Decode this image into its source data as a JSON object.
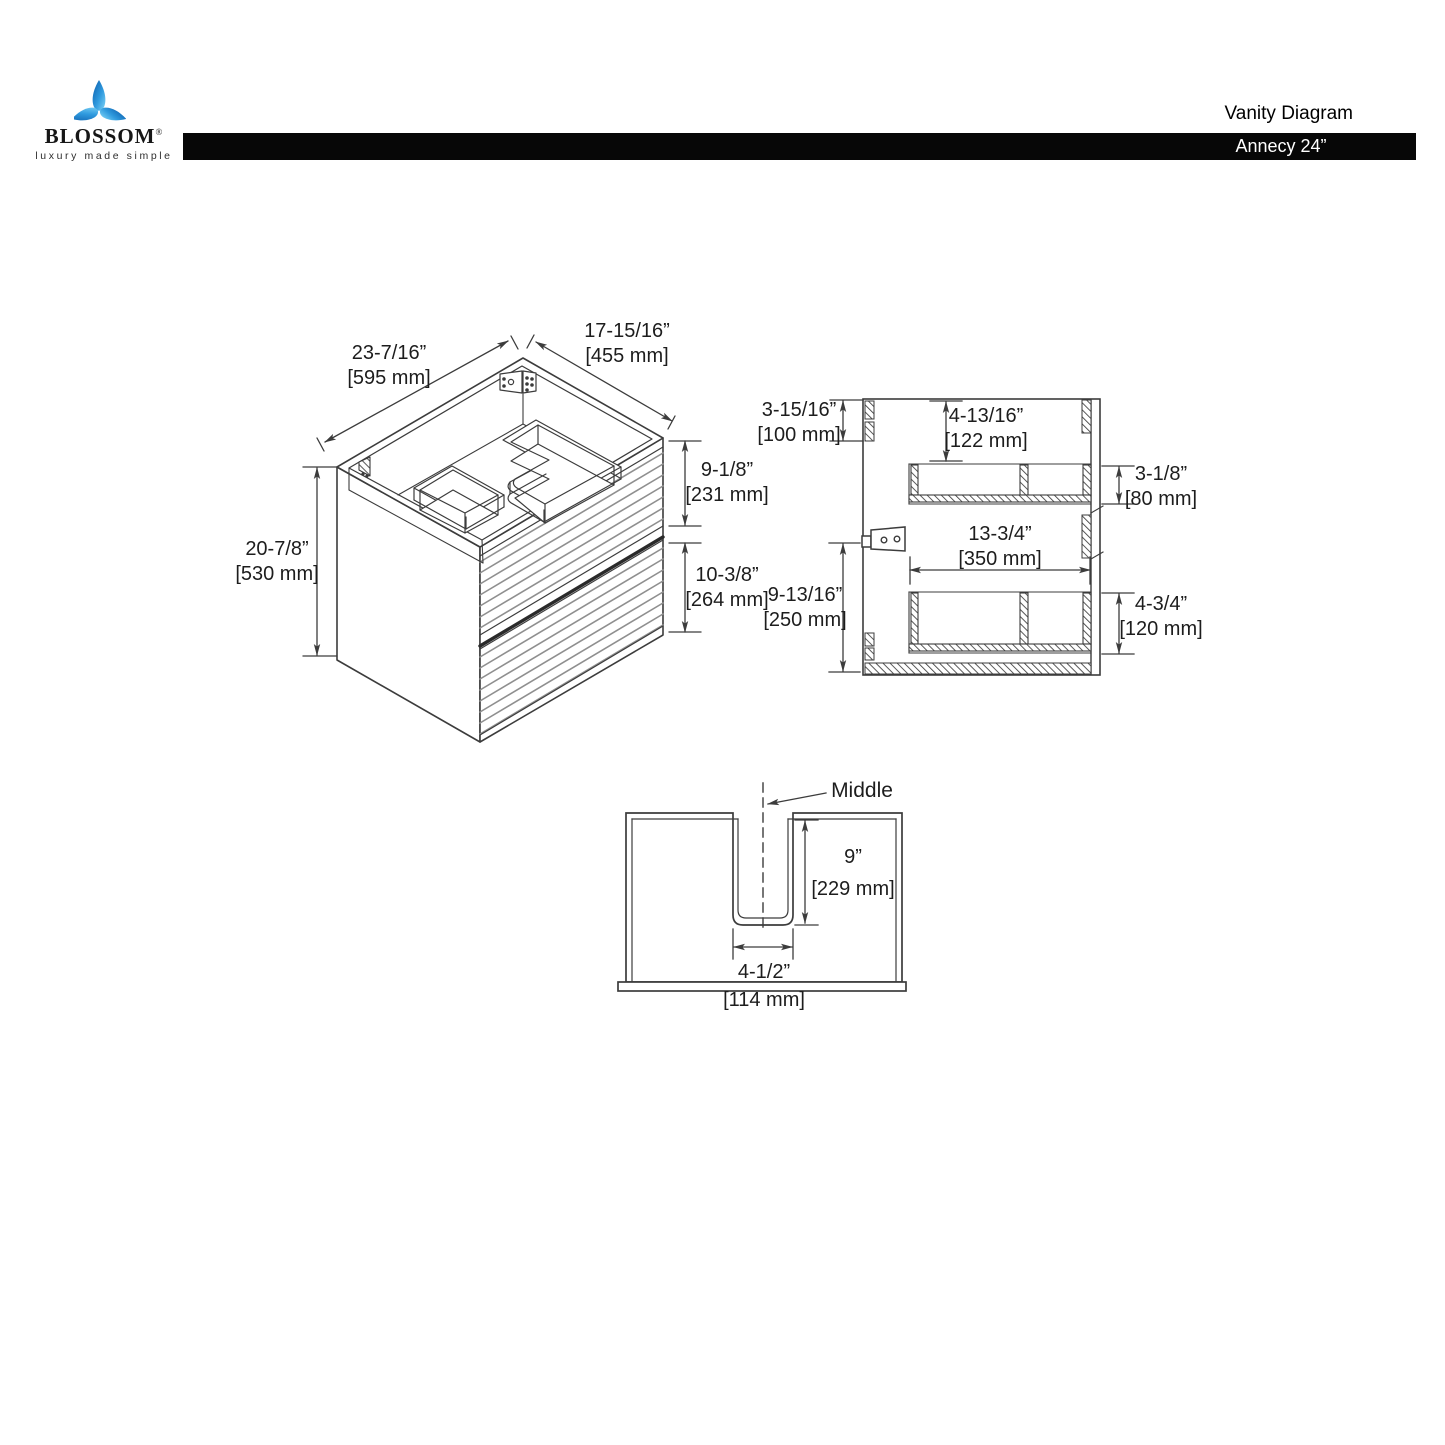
{
  "header": {
    "brand": "BLOSSOM",
    "brand_mark": "®",
    "tagline": "luxury made simple",
    "doc_title": "Vanity Diagram",
    "product": "Annecy 24”"
  },
  "colors": {
    "bar_bg": "#070707",
    "line": "#3c3c3c",
    "stripe": "#8f8f8f",
    "logo_blue_dark": "#0b5cab",
    "logo_blue_light": "#5fc6f2"
  },
  "views": {
    "isometric": {
      "name": "isometric cabinet view",
      "dims": {
        "top_depth": {
          "in": "23-7/16”",
          "mm": "[595 mm]"
        },
        "top_width": {
          "in": "17-15/16”",
          "mm": "[455 mm]"
        },
        "height": {
          "in": "20-7/8”",
          "mm": "[530 mm]"
        },
        "upper_drawer": {
          "in": "9-1/8”",
          "mm": "[231 mm]"
        },
        "lower_drawer": {
          "in": "10-3/8”",
          "mm": "[264 mm]"
        }
      }
    },
    "section": {
      "name": "side section view",
      "dims": {
        "top_offset": {
          "in": "3-15/16”",
          "mm": "[100 mm]"
        },
        "top_to_drawer": {
          "in": "4-13/16”",
          "mm": "[122 mm]"
        },
        "upper_drawer_depth": {
          "in": "3-1/8”",
          "mm": "[80 mm]"
        },
        "drawer_width": {
          "in": "13-3/4”",
          "mm": "[350 mm]"
        },
        "lower_section": {
          "in": "9-13/16”",
          "mm": "[250 mm]"
        },
        "lower_drawer_depth": {
          "in": "4-3/4”",
          "mm": "[120 mm]"
        }
      }
    },
    "bottom": {
      "name": "back cutout view",
      "middle_label": "Middle",
      "dims": {
        "cutout_depth": {
          "in": "9”",
          "mm": "[229 mm]"
        },
        "cutout_width": {
          "in": "4-1/2”",
          "mm": "[114 mm]"
        }
      }
    }
  }
}
